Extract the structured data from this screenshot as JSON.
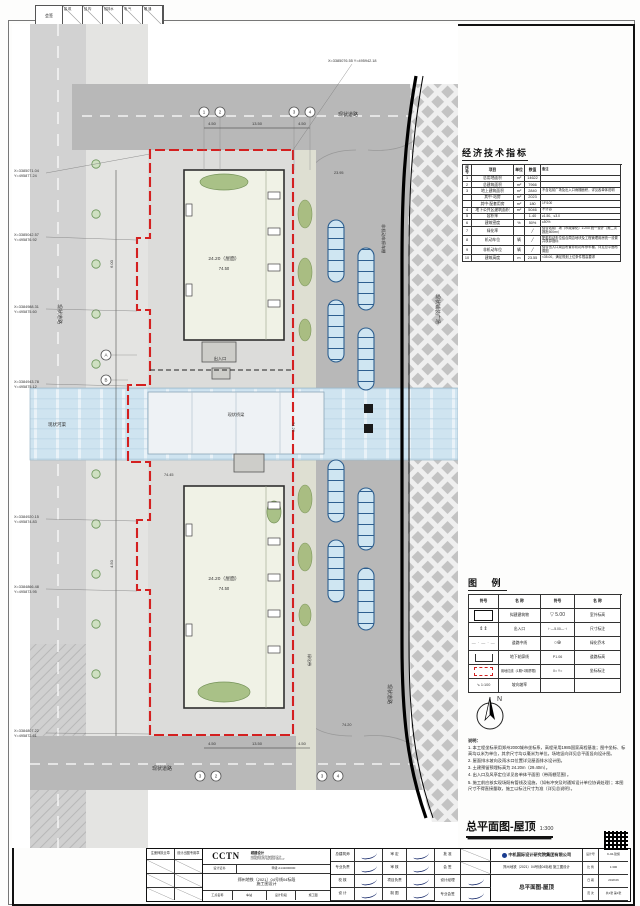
{
  "sheet": {
    "sign_first": "会签",
    "sign_cols": [
      "建 筑",
      "结 构",
      "给排水",
      "电 气",
      "暖 通"
    ]
  },
  "indicators": {
    "title": "经济技术指标",
    "headers": [
      "序号",
      "项目",
      "单位",
      "数值",
      "备注"
    ],
    "rows": [
      {
        "no": "1",
        "item": "总用地面积",
        "unit": "m²",
        "value": "14622",
        "remark": ""
      },
      {
        "no": "2",
        "item": "总建筑面积",
        "unit": "m²",
        "value": "7966",
        "remark": ""
      },
      {
        "no": "3",
        "item": "地上建筑面积",
        "unit": "m²",
        "value": "2840",
        "remark": "不含站前广场及出入口雨棚面积，详见各单体说明"
      },
      {
        "no": "",
        "item": "其中·站房",
        "unit": "m²",
        "value": "2023",
        "remark": ""
      },
      {
        "no": "",
        "item": "其中·配套用房",
        "unit": "m²",
        "value": "180",
        "remark": "1F/100"
      },
      {
        "no": "4",
        "item": "地下公共区建筑面积",
        "unit": "m²",
        "value": "5046",
        "remark": "不计容"
      },
      {
        "no": "5",
        "item": "容积率",
        "unit": "",
        "value": "1.40",
        "remark": "≥1.50、≤3.0"
      },
      {
        "no": "6",
        "item": "建筑密度",
        "unit": "%",
        "value": "50%",
        "remark": "≤50%"
      },
      {
        "no": "7",
        "item": "绿化率",
        "unit": "",
        "value": "╱",
        "remark": "结合站前广场（市政绿化）1:200 统一设计（需二次报批500m²）"
      },
      {
        "no": "8",
        "item": "机动车位",
        "unit": "辆",
        "value": "╱",
        "remark": "配套机动车位结合周边地块及工程管理用房统一设置并核算指标"
      },
      {
        "no": "9",
        "item": "非机动车位",
        "unit": "辆",
        "value": "╱",
        "remark": "结合出入口周边布置非机动车停车棚，详见总平面布置图"
      },
      {
        "no": "10",
        "item": "建筑高度",
        "unit": "m",
        "value": "23.55",
        "remark": "<35.00，满足规划上位条件限高要求"
      }
    ]
  },
  "legend": {
    "title": "图  例",
    "headers": [
      "符号",
      "名 称",
      "符号",
      "名 称"
    ],
    "rows": [
      {
        "name": "拟建建筑物",
        "name2": "室外标高"
      },
      {
        "name": "出入口",
        "name2": "尺寸标注"
      },
      {
        "name": "道路中线",
        "name2": "绿化乔木"
      },
      {
        "name": "地下轮廓线",
        "name2": "道路标高"
      },
      {
        "name": "用地红线（1期+2期界限）",
        "name2": "坐标标注"
      },
      {
        "name": "坡向坡率",
        "name2": ""
      }
    ],
    "sym_bld_text": "±0.00",
    "sym_ent": "⇕⇕",
    "sym_axis": "— · — · —",
    "sym_slope": "⇘ 1:100",
    "sym_lvl": "▽ 5.00",
    "sym_dim": "⊢—5.00—⊣",
    "sym_tree": "○⊕",
    "sym_roadlvl": "P1.06",
    "sym_leader": "X=  Y="
  },
  "compass": {
    "label": "N"
  },
  "notes": {
    "header": "说明：",
    "items": [
      "1. 本工程坐标采用郑州2000城市坐标系，高程采用1985国家高程基准；图中坐标、标高均以米为单位，其余尺寸均以毫米为单位。场地竖向详见总平面竖向设计图。",
      "2. 屋面排水坡向及雨水口位置详见屋面排水设计图。",
      "3. 土建预留预埋标高为 24.20m（29.40m）。",
      "4. 出入口及风亭定位详见各单体平面图（带雨棚范围）。",
      "5. 施工前应核实现场既有管线及设施，（如有冲突及时通知设计单位协调处理）；本图尺寸不得直接量取，施工以标注尺寸为准（详见总说明）。"
    ]
  },
  "drawing_title": {
    "name": "总平面图-屋顶",
    "scale": "1:300"
  },
  "plan": {
    "road_top": "现状道路",
    "road_bottom": "现状道路",
    "road_left": "现状道路",
    "road_right": "现状道路",
    "canal": "现状河渠",
    "bridge": "现状桥梁",
    "plaza": "现状铺装广场",
    "green_belt": "绿化带",
    "shelter": "非机动车停车棚",
    "entrance": "出入口",
    "roof_top_elev": "24.20（屋面）",
    "roof_top_height": "74.50",
    "roof_bottom_elev": "24.20（屋面）",
    "roof_bottom_height": "74.50",
    "canal_elev": "74.20",
    "spots": [
      "23.95",
      "74.45",
      "74.20"
    ],
    "dims": [
      "4.50",
      "13.50",
      "4.50"
    ],
    "dims_left": [
      "6.00",
      "4.50"
    ],
    "grid_top": [
      "1",
      "2",
      "3",
      "4"
    ],
    "grid_bottom": [
      "3",
      "2",
      "3",
      "4"
    ],
    "grid_left": [
      "A",
      "B"
    ],
    "coords": [
      {
        "x": "X=3385071.04",
        "y": "Y=495877.24"
      },
      {
        "x": "X=3385042.57",
        "y": "Y=495876.92"
      },
      {
        "x": "X=3384988.31",
        "y": "Y=495875.60"
      },
      {
        "x": "X=3384943.78",
        "y": "Y=495875.12"
      },
      {
        "x": "X=3384920.15",
        "y": "Y=495874.83"
      },
      {
        "x": "X=3384866.48",
        "y": "Y=495873.95"
      },
      {
        "x": "X=3384807.22",
        "y": "Y=495872.61"
      }
    ],
    "coord_right": "X=3385076.55  Y=495942.18"
  },
  "titleblock": {
    "stamp_headers": [
      "注册师执业章",
      "设计出图专用章"
    ],
    "cctn": {
      "logo": "CCTN",
      "logo_sub": "城建设计",
      "co_line1": "中国城建院咨询规划设计",
      "co_line2": "CHINA CCTN DESIGN GROUP",
      "cert_label": "设计证书",
      "cert_no": "甲级 A141000000",
      "project_l1": "郑州地铁（2021）04号线04标段",
      "project_l2": "施工图设计",
      "sub_cells": [
        "工点名称",
        "车站",
        "设计阶段",
        "施工图"
      ]
    },
    "sig_a": [
      {
        "label": "总建筑师"
      },
      {
        "label": "专业负责"
      },
      {
        "label": "校  核"
      },
      {
        "label": "设  计"
      }
    ],
    "sig_b": [
      {
        "label": "审  定"
      },
      {
        "label": "审  核"
      },
      {
        "label": "项目负责"
      },
      {
        "label": "制  图"
      }
    ],
    "sig_c": {
      "r1": "批  准",
      "r2": "会  签",
      "r3": "设计经理",
      "r4": "专业会签"
    },
    "company": {
      "name": "中机国际设计研究院集团有限公司",
      "project": "郑州地铁（2021）04号线04标段  施工图设计",
      "fig_name": "总平面图-屋顶"
    },
    "meta": [
      [
        "设计号",
        "K-04-建施"
      ],
      [
        "比  例",
        "1:300"
      ],
      [
        "日  期",
        "2018.06"
      ],
      [
        "页  次",
        "共1张 第1张"
      ]
    ]
  }
}
